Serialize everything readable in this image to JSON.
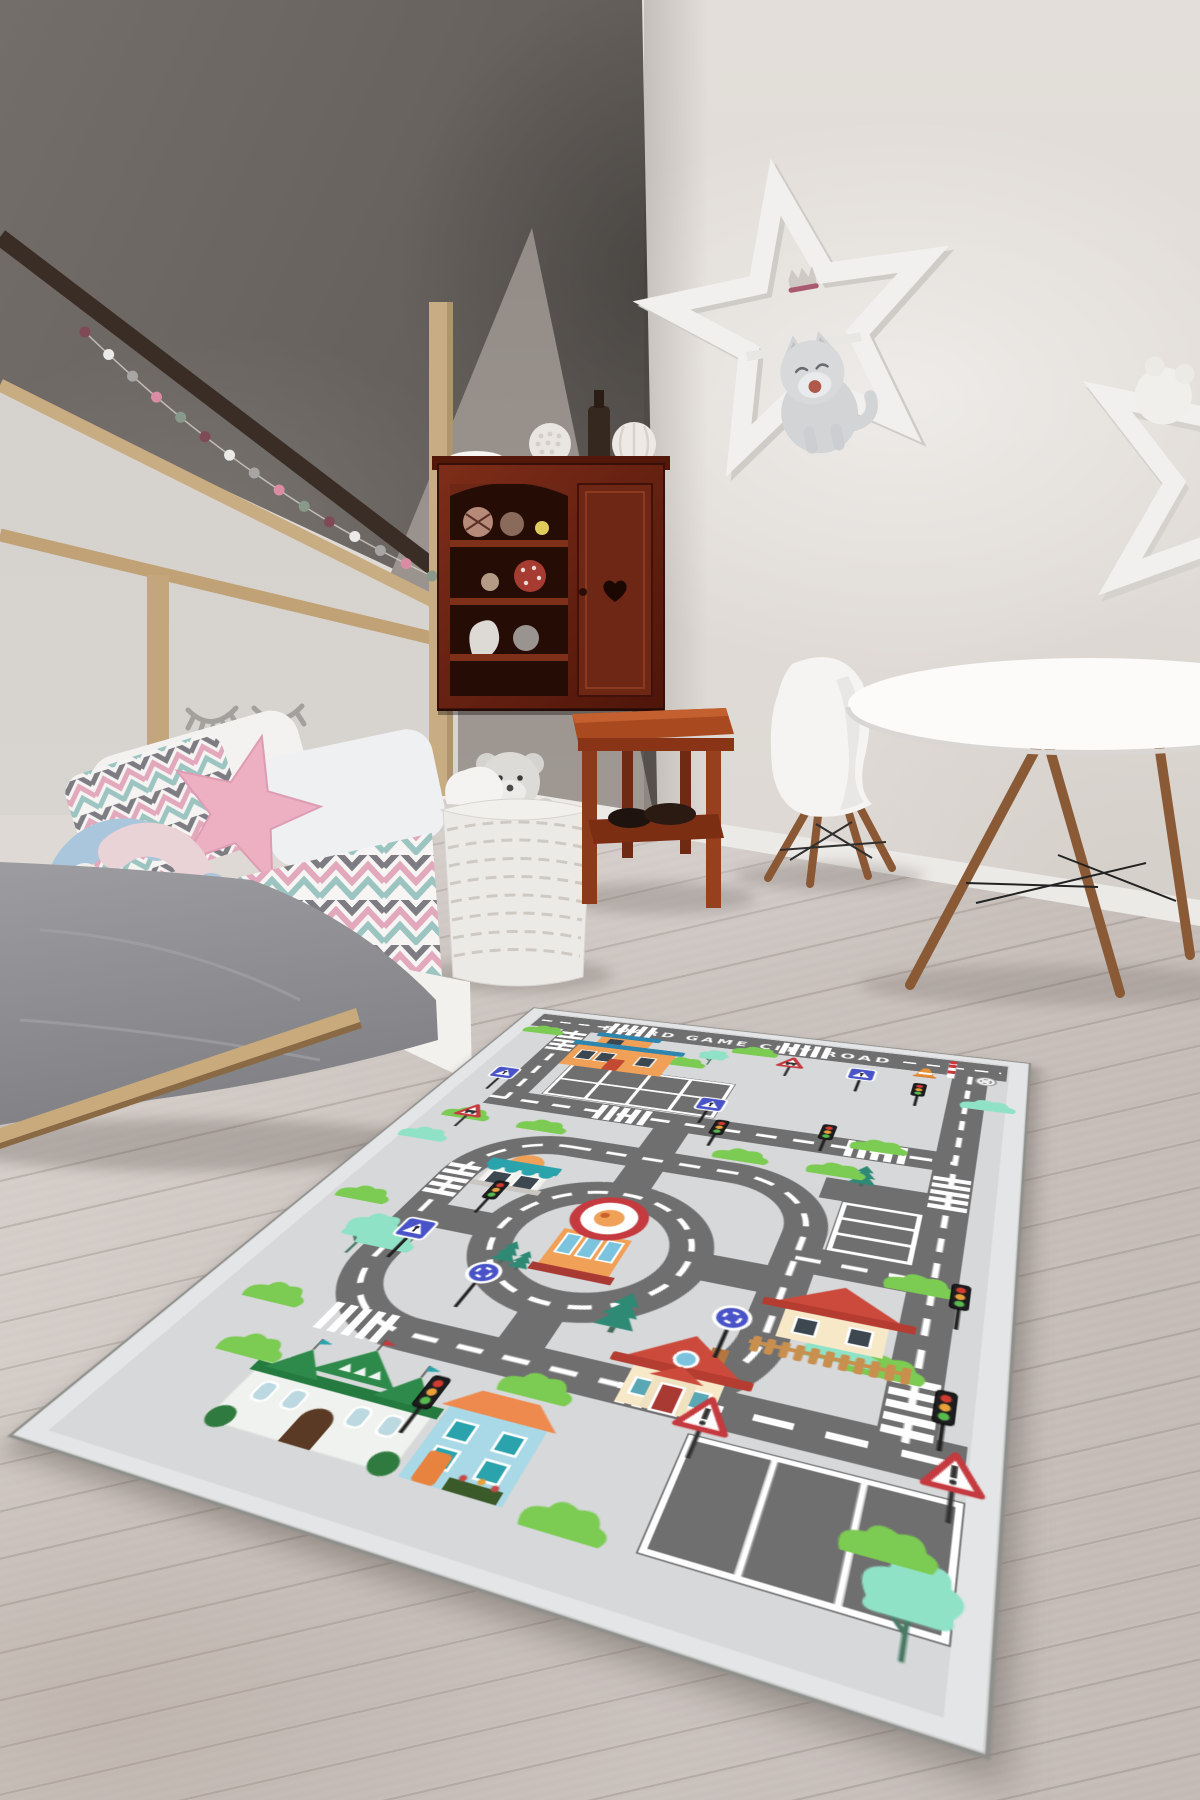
{
  "palette": {
    "wallDark": "#5e5955",
    "wallLight": "#ddd8d3",
    "wallTri": "#a39c96",
    "floor": "#cbc3be",
    "woodLight": "#c8ac82",
    "woodDark": "#3a2d25",
    "cabinetWood": "#6e2817",
    "stoolWood": "#a8491f",
    "blanketGray": "#8f8f92",
    "pillowPink": "#ecb0c2",
    "knotBlue": "#a9c6dc",
    "knotGray": "#b3a8a3",
    "knotPink": "#ead3d6",
    "knotWhite": "#f1eeea",
    "starShelfWhite": "#f2f0ee",
    "plushGray": "#d3d4d6"
  },
  "room": {
    "garland_colors": [
      "#7e4a58",
      "#eceae8",
      "#a8a6a4",
      "#d98ca4",
      "#8a9a8a"
    ]
  },
  "rug": {
    "title": "BOARD GAME  CITY ROAD",
    "colors": {
      "bg": "#d6d8d9",
      "edge": "#e3e5e6",
      "road": "#6f6f70",
      "line": "#ffffff",
      "green": "#7ccb52",
      "mint": "#8fe2c6",
      "pine": "#2e8a74",
      "signBlue": "#4953c8",
      "signRed": "#c43a3f",
      "tlRed": "#d23b2f",
      "tlYellow": "#e8a13a",
      "tlGreen": "#57b94e",
      "orange": "#f0a057",
      "blue": "#2e85ad",
      "teal": "#2aa3ad",
      "cream": "#f7e8c8",
      "roofRed": "#cc4a3c",
      "mansionGreen": "#2e8a4a",
      "houseBlue": "#a9d8e6",
      "roofOrange": "#ef8a4e",
      "fence": "#c98f4e",
      "windowDark": "#3c4750",
      "windowBlue": "#7cc3dd"
    },
    "roads": [
      {
        "d": "M 24 38 H 576",
        "w": 40,
        "line": "none"
      },
      {
        "d": "M 30 38 H 128",
        "w": 0,
        "lw": 4,
        "dash": "14 11"
      },
      {
        "d": "M 468 38 H 570",
        "w": 0,
        "lw": 4,
        "dash": "14 11"
      },
      {
        "d": "M 86 58 V 252"
      },
      {
        "d": "M 68 252 H 540"
      },
      {
        "d": "M 540 56 V 625"
      },
      {
        "d": "M 275 252 V 330",
        "line": "none"
      },
      {
        "d": "M 275 330 V 398",
        "line": "none"
      },
      {
        "d": "M 195 330 H 355 A 80 80 0 0 1 435 410 V 545 A 80 80 0 0 1 355 625 H 195 A 80 80 0 0 1 115 545 V 410 A 80 80 0 0 1 195 330 Z"
      },
      {
        "c": [
          275,
          478,
          82
        ],
        "dash": "18 14"
      },
      {
        "d": "M 115 478 H 193",
        "line": "none"
      },
      {
        "d": "M 357 478 H 435",
        "line": "none"
      },
      {
        "d": "M 275 560 V 625",
        "line": "none"
      },
      {
        "d": "M 355 625 H 576",
        "lw": 6,
        "dash": "26 20"
      },
      {
        "d": "M 435 330 H 540",
        "line": "none"
      },
      {
        "d": "M 435 443 H 540"
      }
    ],
    "island": {
      "x": 275,
      "y": 478,
      "r": 26
    },
    "parkings": [
      {
        "x": 118,
        "y": 148,
        "w": 190,
        "h": 84,
        "rows": 2,
        "slots": 4,
        "o": "v"
      },
      {
        "x": 455,
        "y": 348,
        "w": 68,
        "h": 78,
        "rows": 1,
        "slots": 3,
        "o": "h"
      },
      {
        "x": 412,
        "y": 652,
        "w": 166,
        "h": 96,
        "rows": 1,
        "slots": 3,
        "o": "v"
      }
    ],
    "crosswalks": [
      {
        "x": 150,
        "y": 38,
        "o": "h"
      },
      {
        "x": 360,
        "y": 38,
        "o": "h"
      },
      {
        "x": 86,
        "y": 92,
        "o": "v"
      },
      {
        "x": 218,
        "y": 252,
        "o": "h"
      },
      {
        "x": 470,
        "y": 252,
        "o": "h"
      },
      {
        "x": 540,
        "y": 308,
        "o": "v"
      },
      {
        "x": 540,
        "y": 584,
        "o": "v"
      },
      {
        "x": 386,
        "y": 625,
        "o": "h"
      },
      {
        "x": 150,
        "y": 625,
        "o": "h"
      },
      {
        "x": 115,
        "y": 420,
        "o": "v"
      }
    ],
    "buildings": [
      {
        "type": "school",
        "x": 104,
        "y": 62,
        "w": 120,
        "h": 92
      },
      {
        "type": "kiosk",
        "x": 132,
        "y": 350,
        "w": 72,
        "h": 70
      },
      {
        "type": "roundshop",
        "x": 275,
        "y": 470
      },
      {
        "type": "house",
        "x": 432,
        "y": 470,
        "w": 94,
        "h": 72
      },
      {
        "type": "house2",
        "x": 350,
        "y": 560,
        "w": 80,
        "h": 80
      },
      {
        "type": "mansion",
        "x": 112,
        "y": 648,
        "w": 140,
        "h": 96
      },
      {
        "type": "bluehouse",
        "x": 258,
        "y": 660,
        "w": 70,
        "h": 84
      }
    ],
    "signs": [
      {
        "t": "cross",
        "x": 56,
        "y": 208
      },
      {
        "t": "cross",
        "x": 296,
        "y": 216
      },
      {
        "t": "cross",
        "x": 126,
        "y": 516
      },
      {
        "t": "cross",
        "x": 430,
        "y": 98
      },
      {
        "t": "round",
        "x": 210,
        "y": 556
      },
      {
        "t": "round",
        "x": 408,
        "y": 548
      },
      {
        "t": "warn",
        "x": 418,
        "y": 646
      },
      {
        "t": "warn",
        "x": 570,
        "y": 644
      },
      {
        "t": "warncar",
        "x": 352,
        "y": 86
      },
      {
        "t": "warncar",
        "x": 66,
        "y": 300
      },
      {
        "t": "pole",
        "x": 520,
        "y": 60
      },
      {
        "t": "cone",
        "x": 494,
        "y": 68
      },
      {
        "t": "mini",
        "x": 556,
        "y": 64
      }
    ],
    "traffic_lights": [
      {
        "x": 162,
        "y": 438
      },
      {
        "x": 318,
        "y": 262
      },
      {
        "x": 560,
        "y": 468
      },
      {
        "x": 560,
        "y": 590
      },
      {
        "x": 240,
        "y": 686
      },
      {
        "x": 492,
        "y": 118
      },
      {
        "x": 420,
        "y": 240
      }
    ],
    "trees": [
      {
        "t": "mint",
        "x": 90,
        "y": 534,
        "s": 1.1
      },
      {
        "t": "mint",
        "x": 556,
        "y": 746,
        "s": 1.15
      },
      {
        "t": "mint",
        "x": 264,
        "y": 96,
        "s": 0.75
      },
      {
        "t": "pine",
        "x": 330,
        "y": 560,
        "s": 0.9
      },
      {
        "t": "pine",
        "x": 216,
        "y": 514,
        "s": 0.6
      },
      {
        "t": "pine",
        "x": 232,
        "y": 520,
        "s": 0.5
      },
      {
        "t": "pine",
        "x": 466,
        "y": 306,
        "s": 0.7
      },
      {
        "t": "bush",
        "x": 46,
        "y": 70
      },
      {
        "t": "bush",
        "x": 306,
        "y": 60
      },
      {
        "t": "bush",
        "x": 64,
        "y": 300
      },
      {
        "t": "bush",
        "x": 52,
        "y": 470
      },
      {
        "t": "bush",
        "x": 70,
        "y": 618
      },
      {
        "t": "bush",
        "x": 440,
        "y": 300
      },
      {
        "t": "bush",
        "x": 530,
        "y": 452
      },
      {
        "t": "bush",
        "x": 304,
        "y": 648
      },
      {
        "t": "bush",
        "x": 94,
        "y": 676
      },
      {
        "t": "bush",
        "x": 366,
        "y": 744
      },
      {
        "t": "bush",
        "x": 540,
        "y": 700
      },
      {
        "t": "bush",
        "x": 470,
        "y": 244
      },
      {
        "t": "bush",
        "x": 150,
        "y": 302
      },
      {
        "t": "bush",
        "x": 352,
        "y": 300
      },
      {
        "t": "bush",
        "x": 236,
        "y": 112
      },
      {
        "t": "bush",
        "x": 518,
        "y": 554
      },
      {
        "t": "mintbush",
        "x": 112,
        "y": 528
      },
      {
        "t": "mintbush",
        "x": 488,
        "y": 548
      },
      {
        "t": "mintbush",
        "x": 560,
        "y": 126
      },
      {
        "t": "mintbush",
        "x": 44,
        "y": 352
      }
    ]
  }
}
